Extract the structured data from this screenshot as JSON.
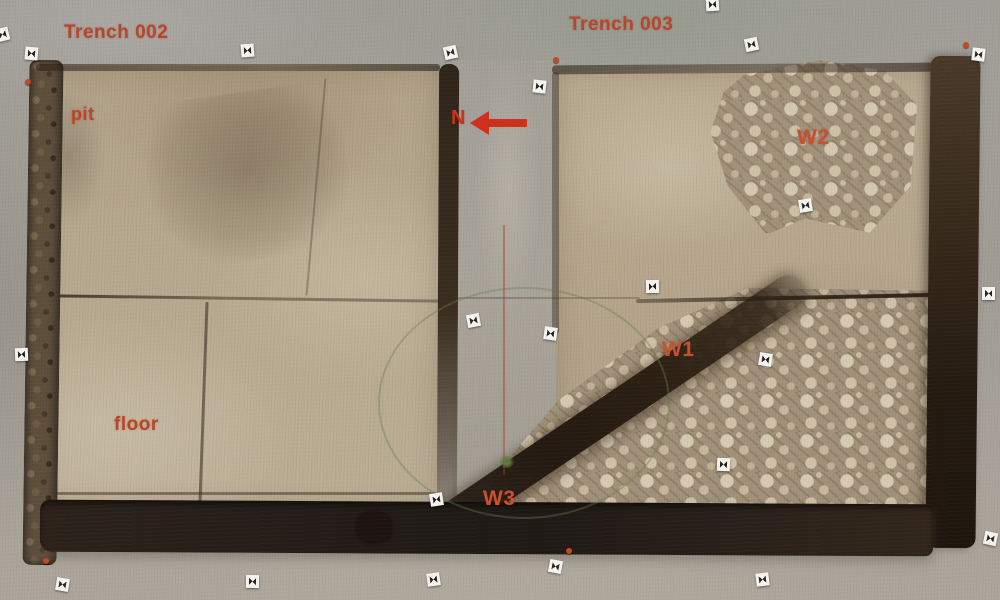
{
  "annotations": {
    "trench_left": "Trench 002",
    "trench_right": "Trench 003",
    "pit": "pit",
    "floor": "floor",
    "wall1": "W1",
    "wall2": "W2",
    "wall3": "W3",
    "north": "N"
  },
  "colors": {
    "annotation_red": "#b8452c",
    "north_arrow_red": "#cf2f1d",
    "ground_gray": "#a7a39b",
    "trench_floor_tan": "#b8aa90",
    "excavation_dark_brown": "#241d18",
    "rubble_stone_light": "#d6cab1"
  },
  "markers": {
    "kind": "photogrammetry-target",
    "positions": [
      [
        2,
        34
      ],
      [
        31,
        53
      ],
      [
        247,
        50
      ],
      [
        450,
        52
      ],
      [
        539,
        86
      ],
      [
        712,
        4
      ],
      [
        751,
        44
      ],
      [
        978,
        54
      ],
      [
        21,
        354
      ],
      [
        473,
        320
      ],
      [
        550,
        333
      ],
      [
        652,
        286
      ],
      [
        805,
        205
      ],
      [
        765,
        359
      ],
      [
        988,
        293
      ],
      [
        436,
        499
      ],
      [
        62,
        584
      ],
      [
        252,
        581
      ],
      [
        433,
        579
      ],
      [
        555,
        566
      ],
      [
        723,
        464
      ],
      [
        762,
        579
      ],
      [
        990,
        538
      ]
    ]
  },
  "nails": {
    "kind": "survey-nail",
    "positions": [
      [
        28,
        82
      ],
      [
        556,
        60
      ],
      [
        966,
        45
      ],
      [
        46,
        561
      ],
      [
        569,
        551
      ]
    ]
  }
}
